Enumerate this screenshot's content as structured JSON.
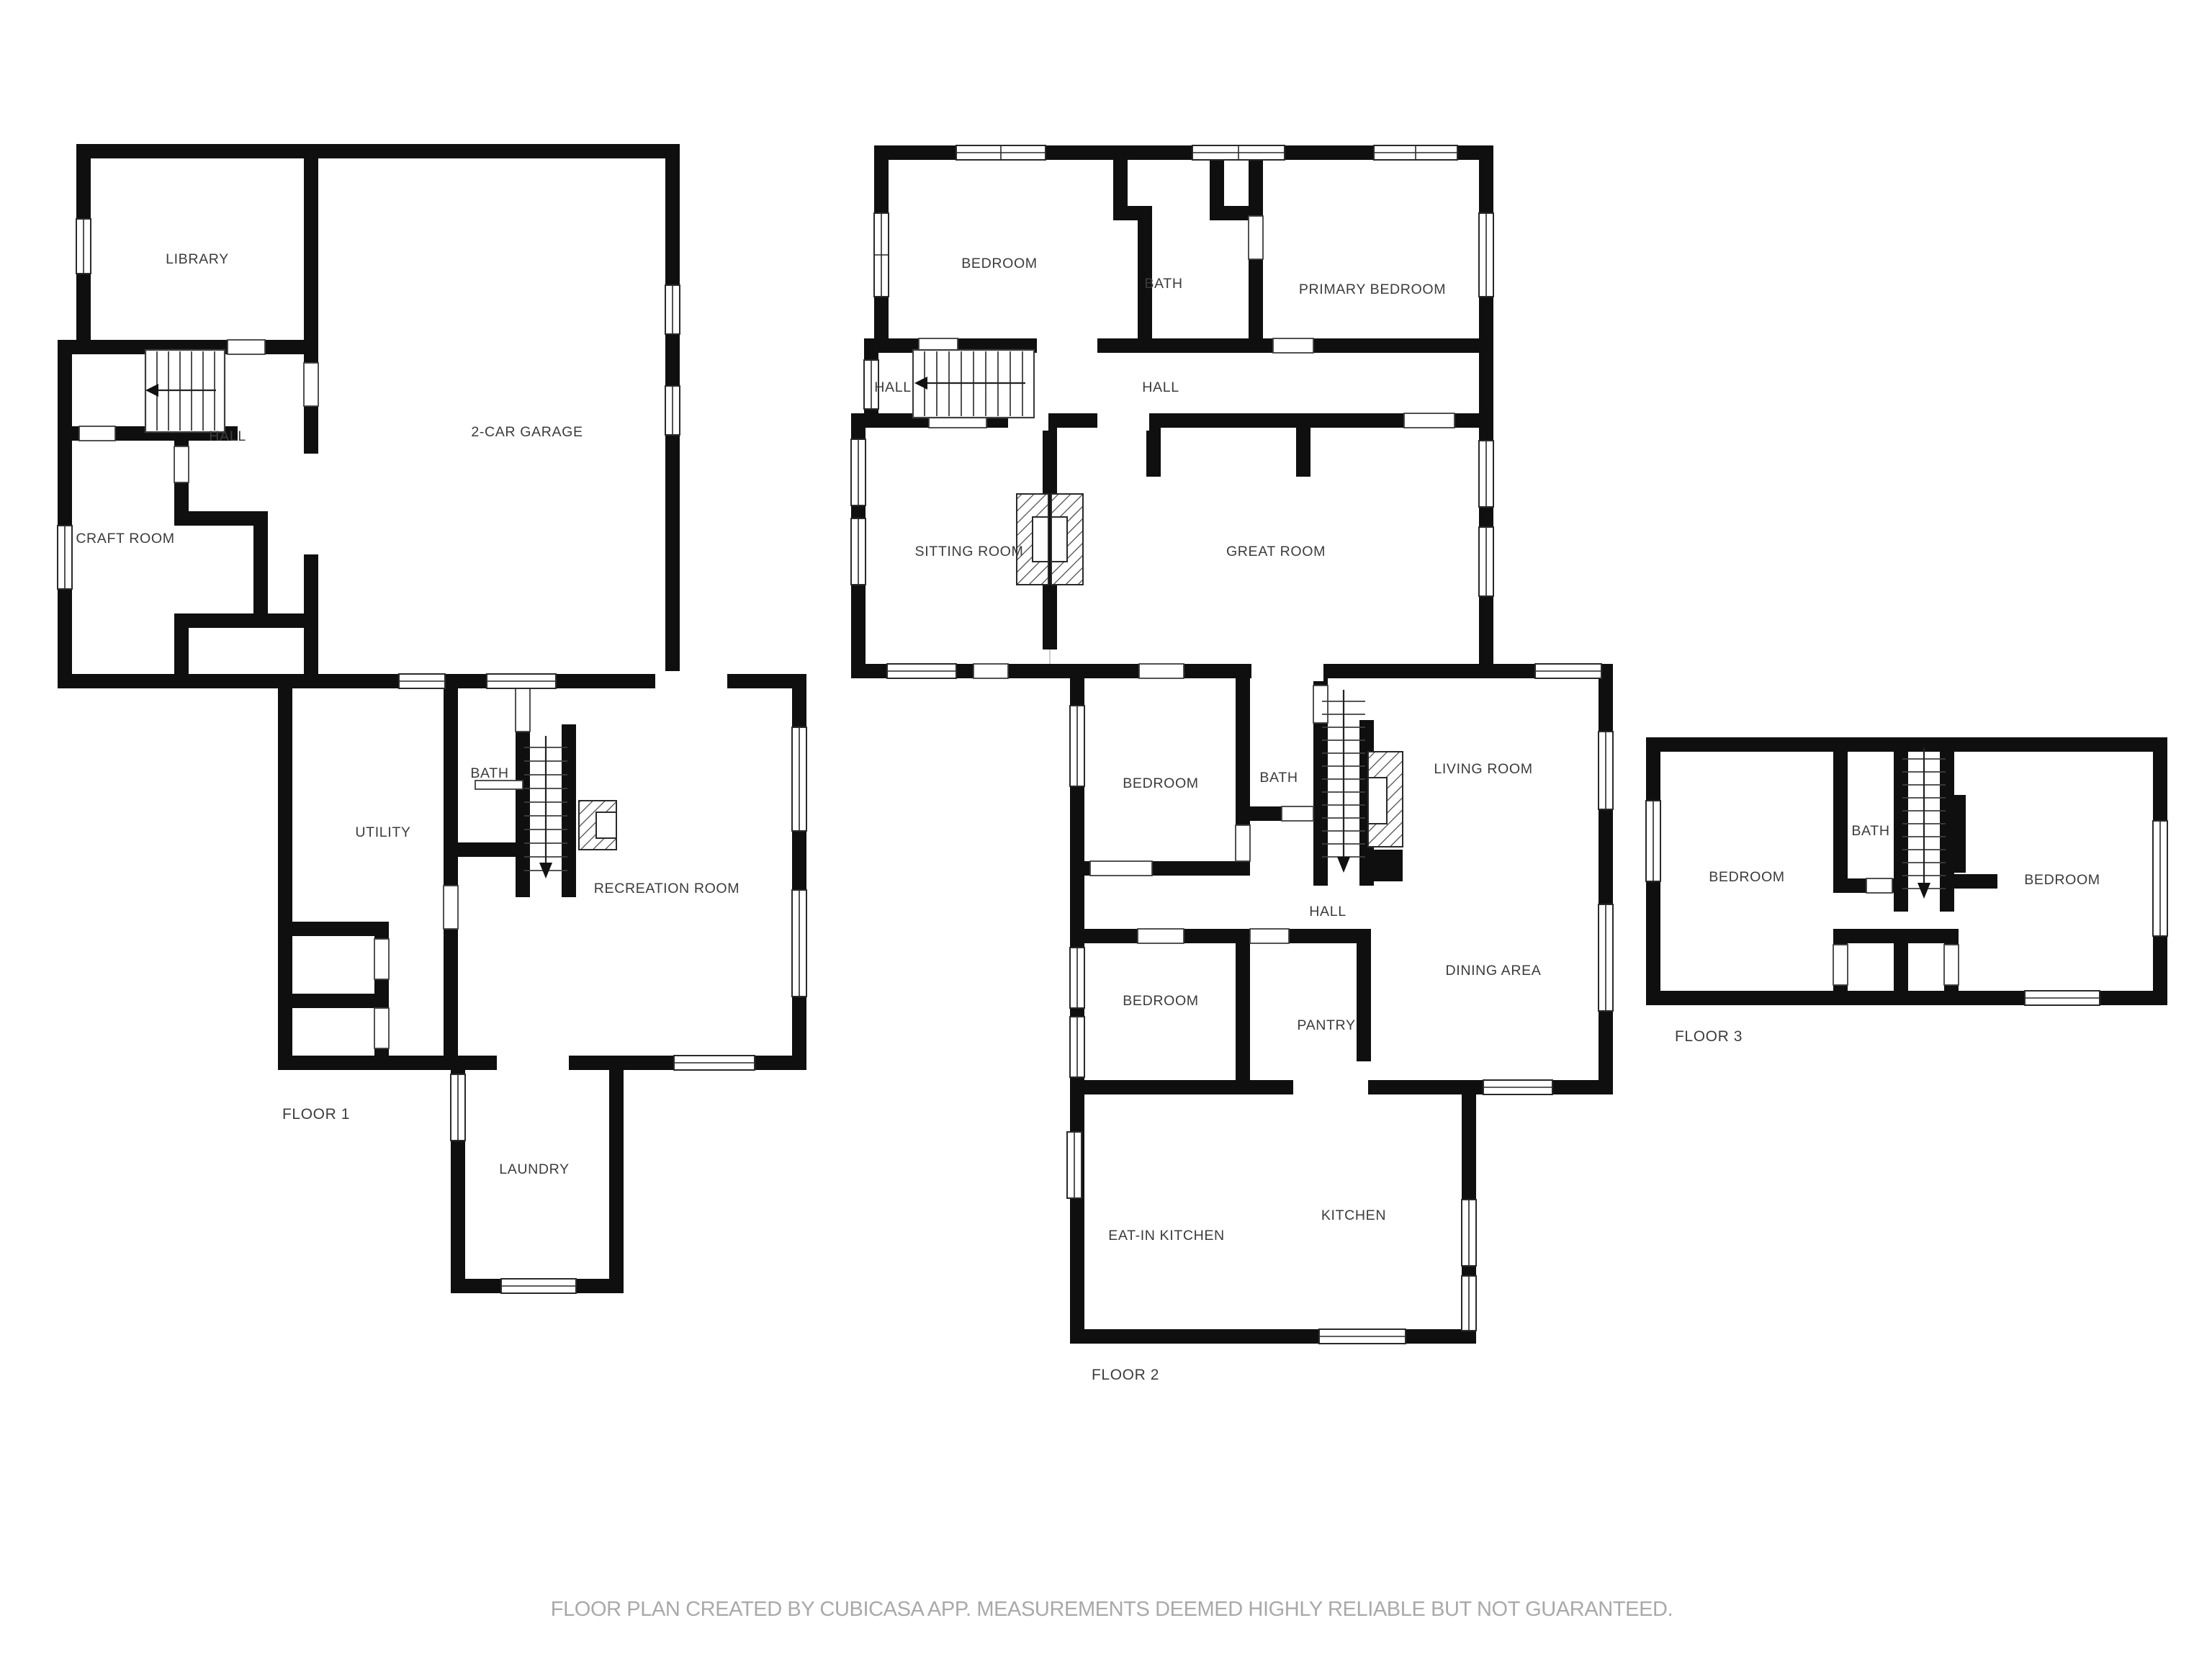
{
  "caption": "FLOOR PLAN CREATED BY CUBICASA APP. MEASUREMENTS DEEMED HIGHLY RELIABLE BUT NOT GUARANTEED.",
  "colors": {
    "wall": "#0f0f0f",
    "label": "#3c3c3c",
    "caption": "#a9a9a9",
    "background": "#ffffff"
  },
  "floors": [
    {
      "name": "FLOOR 1",
      "rooms": [
        {
          "label": "LIBRARY"
        },
        {
          "label": "2-CAR GARAGE"
        },
        {
          "label": "HALL"
        },
        {
          "label": "CRAFT ROOM"
        },
        {
          "label": "BATH"
        },
        {
          "label": "UTILITY"
        },
        {
          "label": "RECREATION ROOM"
        },
        {
          "label": "LAUNDRY"
        }
      ]
    },
    {
      "name": "FLOOR 2",
      "rooms": [
        {
          "label": "BEDROOM"
        },
        {
          "label": "BATH"
        },
        {
          "label": "PRIMARY BEDROOM"
        },
        {
          "label": "HALL"
        },
        {
          "label": "HALL"
        },
        {
          "label": "SITTING ROOM"
        },
        {
          "label": "GREAT ROOM"
        },
        {
          "label": "BEDROOM"
        },
        {
          "label": "BATH"
        },
        {
          "label": "LIVING ROOM"
        },
        {
          "label": "HALL"
        },
        {
          "label": "BEDROOM"
        },
        {
          "label": "PANTRY"
        },
        {
          "label": "DINING AREA"
        },
        {
          "label": "EAT-IN KITCHEN"
        },
        {
          "label": "KITCHEN"
        }
      ]
    },
    {
      "name": "FLOOR 3",
      "rooms": [
        {
          "label": "BEDROOM"
        },
        {
          "label": "BATH"
        },
        {
          "label": "BEDROOM"
        }
      ]
    }
  ]
}
